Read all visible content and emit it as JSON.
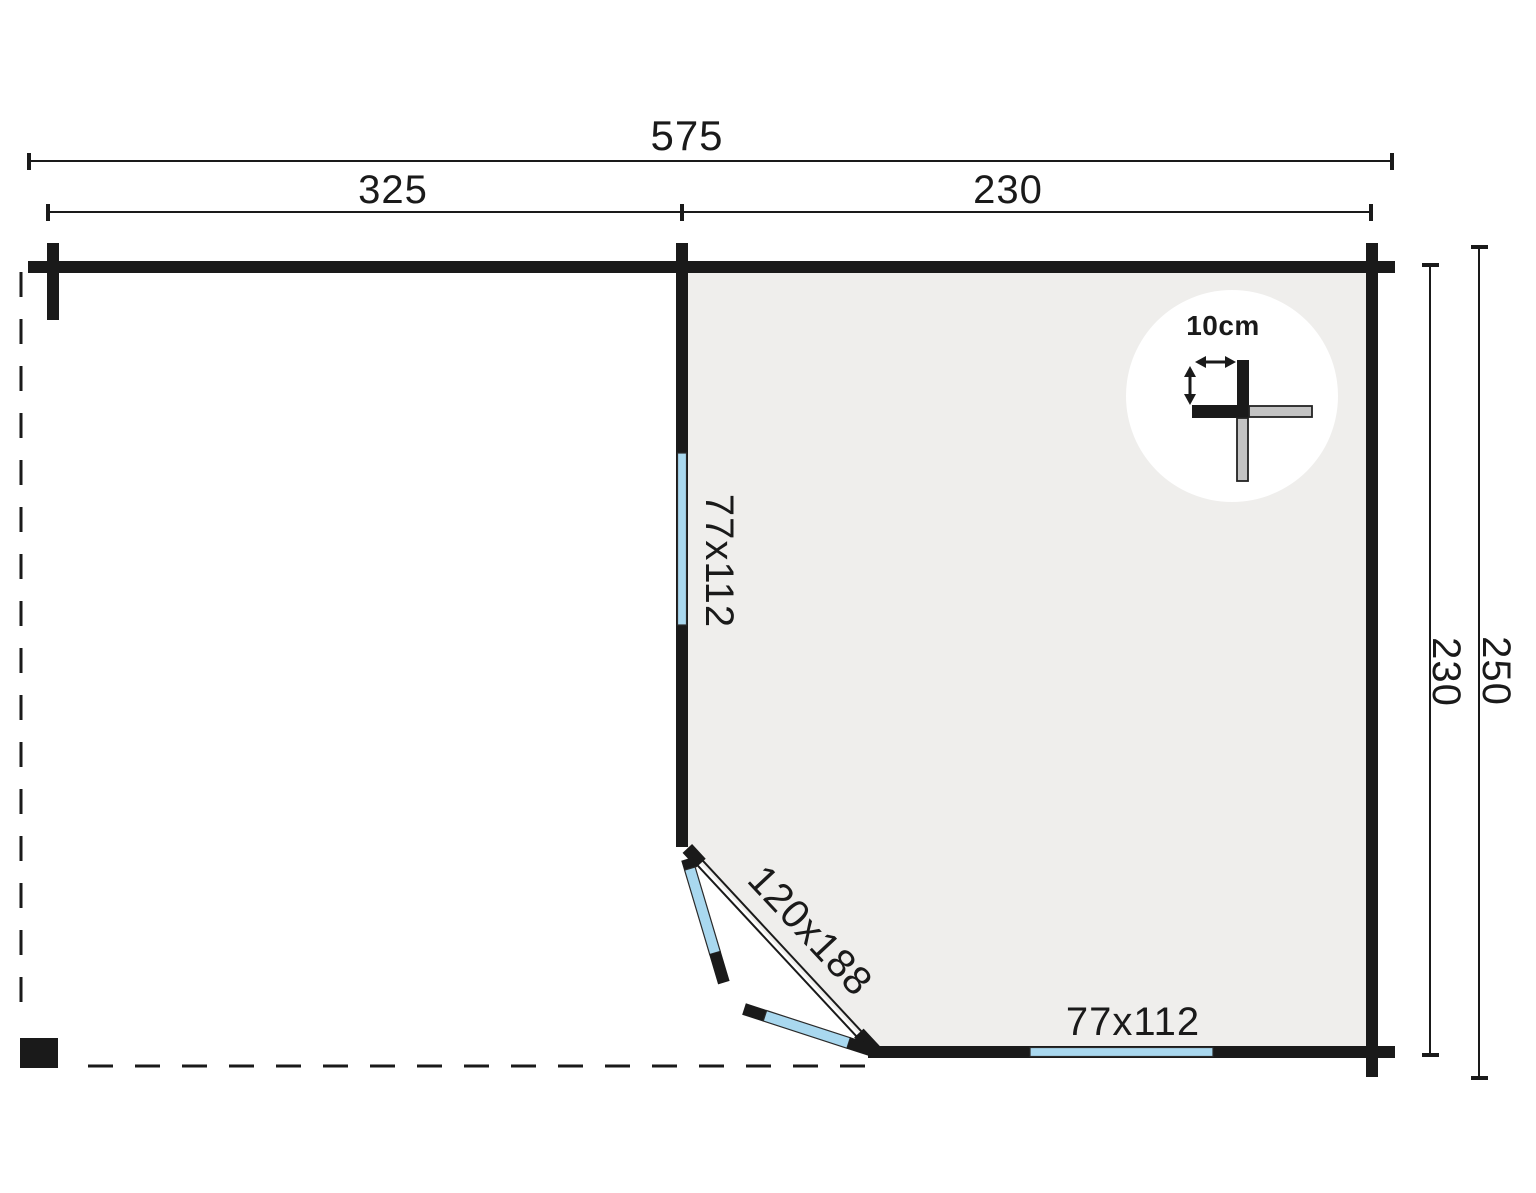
{
  "plan": {
    "title": "garden-house-floorplan",
    "labels": {
      "overall_width": "575",
      "porch_width": "325",
      "cabin_width": "230",
      "cabin_depth": "230",
      "overall_depth": "250",
      "left_window_size": "77x112",
      "door_size": "120x188",
      "bottom_window_size": "77x112",
      "wall_thickness": "10cm"
    },
    "colors": {
      "wall": "#1a1a1a",
      "glass": "#a9d8ef",
      "floor": "#efeeec",
      "log_end": "#c3c3c3",
      "ink": "#1a1a1a"
    }
  }
}
